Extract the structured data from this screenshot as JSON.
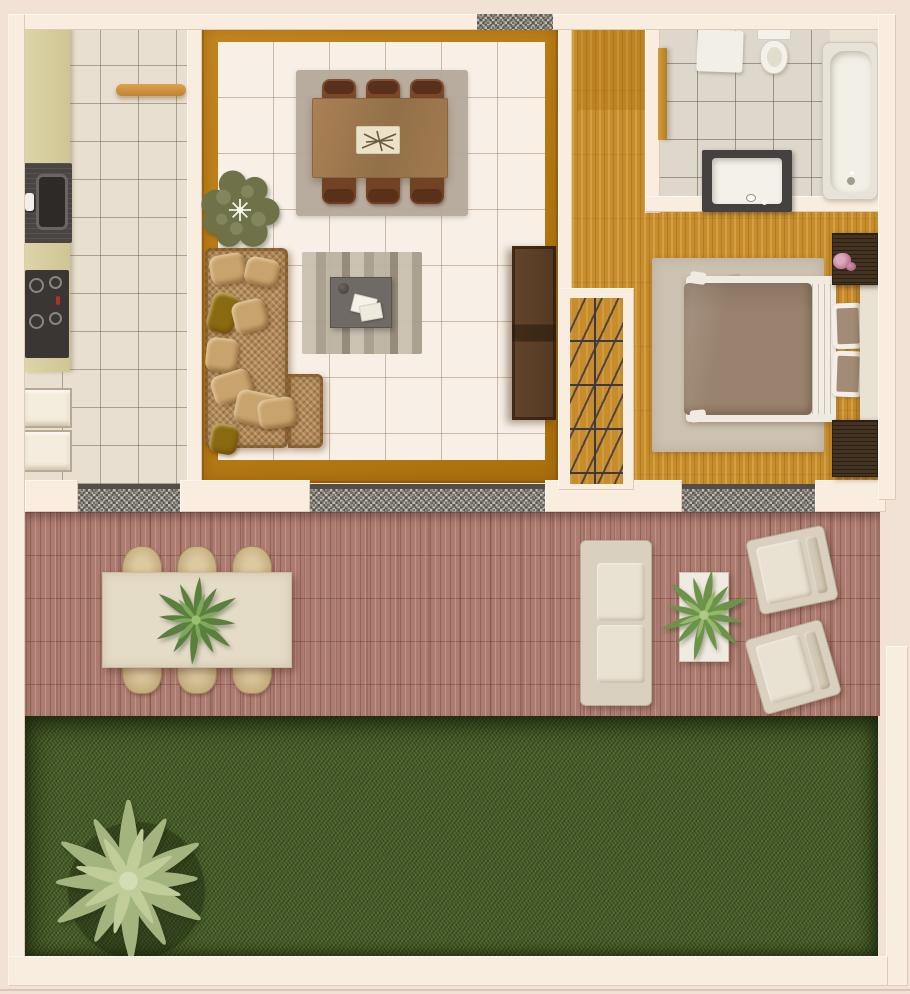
{
  "scene": {
    "type": "architectural-floor-plan-3d-render",
    "description": "Top-down 3D rendered floor plan of a one-bedroom house with kitchen, living-dining room, hallway with staircase, bathroom, bedroom, wooden deck terrace and lawn garden",
    "rooms": {
      "kitchen": {
        "label": "Kitchen"
      },
      "living": {
        "label": "Living and dining room"
      },
      "hallway": {
        "label": "Entry hallway with staircase"
      },
      "bathroom": {
        "label": "Bathroom"
      },
      "bedroom": {
        "label": "Bedroom"
      },
      "deck": {
        "label": "Outdoor wood deck terrace"
      },
      "garden": {
        "label": "Lawn garden"
      }
    },
    "furniture": {
      "kitchen_counter": "Kitchen counter",
      "sink": "Kitchen sink",
      "cooktop": "Four-burner cooktop",
      "appliances": "Built-in appliances",
      "shelf": "Wall-mounted wooden shelf",
      "dining_table": "Dining table with six chairs",
      "tray": "Decorative tray with twigs",
      "indoor_plant": "Potted olive-green plant",
      "sofa": "L-shaped rattan sectional sofa with cushions",
      "coffee_table": "Gray coffee table on striped rug",
      "sideboard": "Dark wooden sideboard",
      "front_door": "Entry door",
      "staircase": "Staircase",
      "bathroom_door": "Bathroom door",
      "toilet": "Toilet",
      "bath_mat": "Bath mat",
      "vanity": "Vanity with washbasin",
      "bathtub": "Bathtub",
      "bed": "Double bed with taupe duvet and two pillows",
      "nightstand": "Wicker nightstand",
      "flower": "Pink flower decoration",
      "bedroom_rug": "Beige bedroom rug",
      "outdoor_table": "Outdoor dining table with six wicker chairs",
      "outdoor_plant": "Green plant centerpiece",
      "outdoor_sofa": "Outdoor cream sofa",
      "outdoor_armchair": "Outdoor cream armchair",
      "side_table": "White side table with plant",
      "palm_tree": "Palm tree",
      "lawn": "Grass lawn",
      "threshold": "Granite threshold / window sill"
    }
  },
  "palette": {
    "bg": "#f2e2d5",
    "wall": "#f8edde",
    "kitchenTile": "#e8dfd1",
    "counter": "#d9d0a2",
    "dark": "#3c3835",
    "oak": "#c78c2b",
    "livingWood": "#bc7e19",
    "livingTile": "#f8f0e7",
    "rugGray": "#b2a699",
    "tableWood": "#a57e53",
    "chair": "#7c4a28",
    "rattan": "#b28a59",
    "rattanLight": "#c8a36d",
    "olive": "#8a6a10",
    "coffee": "#6f6a66",
    "sideboard": "#5a3e26",
    "bathTile": "#ded7cb",
    "fixture": "#f4f1ea",
    "vanity": "#454140",
    "tub": "#e7e3d8",
    "bedRug": "#cdc2b1",
    "duvet": "#99836e",
    "sheet": "#f2ede4",
    "pillowCore": "#a28c77",
    "nightstand": "#453322",
    "headboard": "#e9e1d2",
    "pink": "#c989a2",
    "granite": "#8f8a82",
    "deck": "#ad7c71",
    "outTable": "#e5dcc8",
    "wicker": "#c9b68d",
    "outFrame": "#d9d0bf",
    "outCushion": "#e9e2d3",
    "sideTable": "#f0ebe0",
    "grass": "#4e632d",
    "stair": "#3d3845"
  }
}
